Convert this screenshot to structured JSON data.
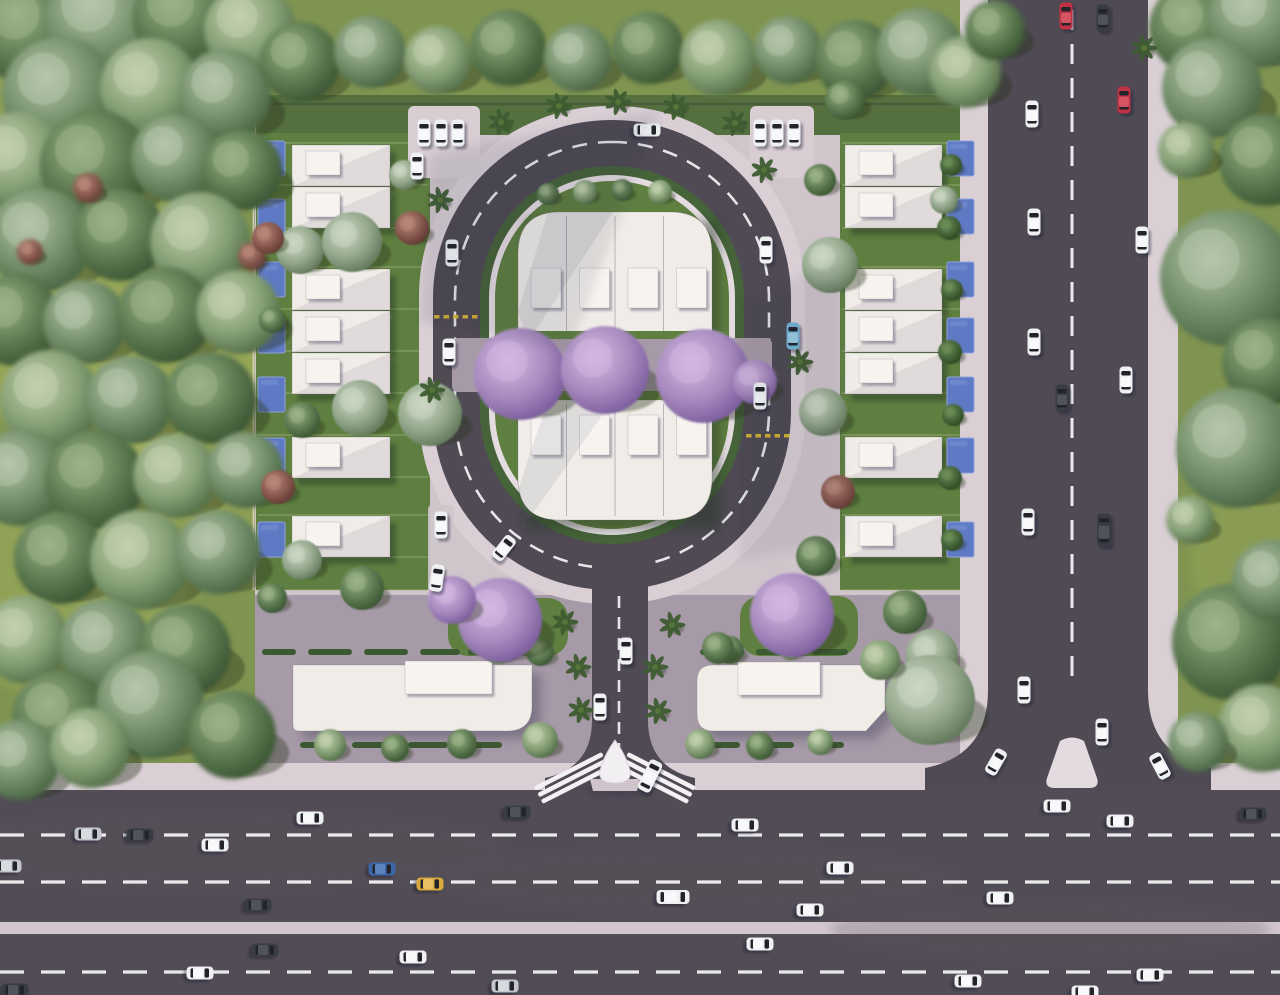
{
  "scene": {
    "w": 1280,
    "h": 995,
    "label": "aerial-residential-masterplan-render"
  },
  "palette": {
    "grass": "#7f9450",
    "lawn": "#5f7f40",
    "topLawn": "#55703f",
    "asphalt": "#514c55",
    "asphaltAvenue": "#4f4a54",
    "sidewalk": "#d9cfd5",
    "median": "#d3c7cd",
    "kerb": "#e4dce1",
    "plaza": "#a79aa8",
    "compoundPave": "#cfc5cb",
    "hedge": "#46633a",
    "white": "#f0ede8",
    "roofBox": "#f7f4f0",
    "island": "#e3dbe0",
    "marking": "#f3f3f6",
    "yellow": "#d9b833",
    "planter": "#3c5a31",
    "bench": "#8a6b4e",
    "glow": "#d8da6e",
    "fence": "#e8e0d4",
    "wall": "#3f4438",
    "dividerLine": "#aab887",
    "treeShadow": "rgba(38,45,28,0.38)",
    "buildShadow": "rgba(40,52,30,0.45)",
    "paveShadow": "rgba(60,60,82,0.38)",
    "cloudShadow": "#232840",
    "pool": "#5f7ac4",
    "poolLight": "#7e97d6",
    "poolDark": "#44straight"
  },
  "treeColors": {
    "f1": {
      "hi": "#b6c7ac",
      "base": "#74906b",
      "lo": "#44603f"
    },
    "f2": {
      "hi": "#9db489",
      "base": "#5e7b52",
      "lo": "#36512f"
    },
    "f3": {
      "hi": "#c3d2ae",
      "base": "#87a178",
      "lo": "#4e6a43"
    },
    "sage": {
      "hi": "#cdd8c4",
      "base": "#95a98e",
      "lo": "#5d7355"
    },
    "red": {
      "hi": "#b98a7c",
      "base": "#8a5a50",
      "lo": "#5e372f"
    },
    "jac": {
      "hi": "#d3b9e2",
      "base": "#a98cc0",
      "lo": "#77589a"
    },
    "bush": {
      "hi": "#6f8f58",
      "base": "#47663a",
      "lo": "#2c441f"
    },
    "palm": {
      "hi": "#55743a",
      "base": "#3e5c31",
      "lo": "#27401f"
    }
  },
  "carColors": {
    "white": {
      "body": "#eef0f2",
      "roof": "#f8f9fb"
    },
    "silver": {
      "body": "#c3c6cc",
      "roof": "#d8dbe0"
    },
    "dark": {
      "body": "#3a3c44",
      "roof": "#50525c"
    },
    "red": {
      "body": "#c03243",
      "roof": "#d45562"
    },
    "blue": {
      "body": "#3c66a8",
      "roof": "#5b83c0"
    },
    "yellow": {
      "body": "#d8a93c",
      "roof": "#e7c064"
    },
    "cyan": {
      "body": "#74b4d6",
      "roof": "#9bcde6"
    }
  },
  "highway": {
    "sidewalk": [
      0,
      763,
      1280,
      27
    ],
    "roadA": [
      0,
      790,
      1280,
      132
    ],
    "dashesA": [
      835,
      882
    ],
    "median": [
      0,
      922,
      1280,
      12
    ],
    "roadB": [
      0,
      934,
      1280,
      61
    ],
    "dashesB": [
      972
    ],
    "dash": "24 17"
  },
  "avenue": {
    "road": [
      988,
      0,
      160,
      790
    ],
    "dashX": 1072,
    "dashY": [
      10,
      688
    ],
    "dash": "20 14",
    "swLeft": [
      960,
      0,
      28,
      765
    ],
    "swRight": [
      1148,
      0,
      30,
      765
    ],
    "flares": [
      "M988,690 Q988,756 925,768 L925,790 L988,790 Z",
      "M1148,690 Q1148,756 1211,768 L1211,790 L1148,790 Z"
    ],
    "island": "M1060,741 Q1072,734 1084,741 L1097,778 Q1100,788 1089,788 L1055,788 Q1044,788 1047,778 Z"
  },
  "compound": {
    "pave": [
      255,
      95,
      710,
      670
    ],
    "topLawn": [
      256,
      95,
      710,
      40
    ],
    "plaza": [
      255,
      595,
      710,
      168
    ],
    "lawnLeft": [
      256,
      133,
      174,
      457
    ],
    "lawnRight": [
      840,
      133,
      136,
      457
    ],
    "lawnPatches": [
      [
        448,
        598,
        120,
        58
      ],
      [
        740,
        596,
        118,
        60
      ]
    ],
    "fenceLeftX": 253.5,
    "fenceRightX": 977,
    "fenceY": [
      133,
      590
    ],
    "wallY": 104,
    "wallX": [
      258,
      960
    ],
    "dividers": [
      143,
      185,
      228,
      267,
      309,
      351,
      393,
      435,
      477,
      515,
      557,
      590
    ],
    "divLeft": [
      258,
      428
    ],
    "divRight": [
      842,
      974
    ],
    "planterY": [
      649,
      742
    ],
    "plantersRow1": [
      [
        262,
        34
      ],
      [
        308,
        44
      ],
      [
        364,
        44
      ],
      [
        420,
        40
      ],
      [
        468,
        44
      ],
      [
        700,
        44
      ],
      [
        756,
        40
      ],
      [
        812,
        36
      ]
    ],
    "plantersRow2": [
      [
        300,
        40
      ],
      [
        352,
        44
      ],
      [
        408,
        40
      ],
      [
        462,
        40
      ],
      [
        700,
        40
      ],
      [
        754,
        40
      ],
      [
        808,
        36
      ]
    ]
  },
  "oval": {
    "sidewalk": [
      419,
      106,
      386,
      498,
      190
    ],
    "road": [
      433,
      120,
      358,
      470,
      178
    ],
    "hedge": [
      480,
      166,
      264,
      378,
      132
    ],
    "kerb": [
      489,
      175,
      246,
      360,
      123
    ],
    "lawn": [
      495,
      181,
      234,
      348,
      117
    ],
    "dashRing": [
      455,
      142,
      314,
      426,
      157
    ],
    "dash": "15 11",
    "yellowRows": [
      [
        434,
        315
      ],
      [
        746,
        434
      ]
    ],
    "parkLeft": [
      408,
      106,
      72,
      72
    ],
    "parkRight": [
      750,
      106,
      64,
      72
    ],
    "parkSide": [
      428,
      505,
      26,
      96
    ]
  },
  "entrance": {
    "road": [
      592,
      560,
      56,
      230
    ],
    "dashX": 619,
    "dashY": [
      596,
      757
    ],
    "dash": "12 9",
    "flares": [
      "M592,720 Q592,768 545,778 L545,790 L592,790 Z",
      "M648,720 Q648,768 695,778 L695,790 L648,790 Z"
    ]
  },
  "innerBlock": {
    "top": {
      "path": "M518,342 L518,254 Q518,212 560,212 L670,212 Q712,212 712,254 L712,342 Z",
      "boxY": 268
    },
    "bottom": {
      "path": "M518,400 L712,400 L712,478 Q712,520 670,520 L560,520 Q518,520 518,478 Z",
      "boxY": 415
    },
    "x": 518,
    "w": 194,
    "unitW": 48.5,
    "units": 4,
    "box": {
      "dx": 13,
      "w": 30,
      "h": 40
    },
    "dividerX": [
      566.5,
      615,
      663.5
    ],
    "topYr": [
      212,
      342
    ],
    "botYr": [
      400,
      520
    ],
    "walkway": [
      452,
      338,
      320,
      54
    ],
    "benches": [
      [
        537,
        348
      ],
      [
        695,
        350
      ]
    ],
    "lawnStrips": [
      [
        495,
        331,
        234,
        8
      ],
      [
        495,
        391,
        234,
        9
      ]
    ]
  },
  "houses": {
    "rowYs": [
      145,
      187,
      269,
      311,
      353,
      437,
      516
    ],
    "h": 41,
    "leftX": 292,
    "leftW": 98,
    "rightX": 845,
    "rightW": 97,
    "box": {
      "dx": 14,
      "dy": 6,
      "w": 34,
      "h": 24
    }
  },
  "pools": {
    "ys": [
      141,
      199,
      262,
      318,
      377,
      438,
      522
    ],
    "leftX": 258,
    "rightX": 947,
    "w": 27,
    "h": 35
  },
  "bottomBuildings": {
    "left": {
      "path": "M293,665 L532,665 L532,706 Q532,731 507,731 L299,731 Q293,731 293,725 Z",
      "box": [
        405,
        661,
        87,
        33
      ]
    },
    "right": {
      "path": "M713,665 L885,665 L885,710 L866,731 L713,731 Q697,731 697,714 L697,681 Q697,665 713,665 Z",
      "box": [
        738,
        662,
        82,
        33
      ]
    }
  },
  "gate": {
    "cx": 615,
    "base": "M590,779 L640,779 L637,791 L593,791 Z",
    "shield": "M615,740 Q603,757 600,771 Q598,783 615,783 Q632,783 630,771 Q627,757 615,740 Z",
    "wingLen": 76,
    "wingAngle": 27
  },
  "forestTrees": [
    [
      30,
      30,
      55,
      "f2"
    ],
    [
      105,
      22,
      60,
      "f1"
    ],
    [
      185,
      18,
      52,
      "f2"
    ],
    [
      250,
      30,
      46,
      "f3"
    ],
    [
      60,
      95,
      58,
      "f1"
    ],
    [
      150,
      88,
      50,
      "f3"
    ],
    [
      225,
      95,
      46,
      "f1"
    ],
    [
      18,
      162,
      50,
      "f3"
    ],
    [
      95,
      165,
      55,
      "f2"
    ],
    [
      175,
      158,
      44,
      "f1"
    ],
    [
      242,
      170,
      40,
      "f2"
    ],
    [
      40,
      240,
      52,
      "f1"
    ],
    [
      120,
      235,
      46,
      "f2"
    ],
    [
      200,
      242,
      50,
      "f3"
    ],
    [
      15,
      320,
      46,
      "f2"
    ],
    [
      85,
      322,
      42,
      "f1"
    ],
    [
      165,
      315,
      48,
      "f2"
    ],
    [
      238,
      312,
      42,
      "f3"
    ],
    [
      50,
      400,
      50,
      "f3"
    ],
    [
      130,
      400,
      44,
      "f1"
    ],
    [
      210,
      398,
      46,
      "f2"
    ],
    [
      20,
      478,
      48,
      "f1"
    ],
    [
      95,
      480,
      50,
      "f2"
    ],
    [
      175,
      476,
      42,
      "f3"
    ],
    [
      245,
      470,
      38,
      "f1"
    ],
    [
      60,
      558,
      46,
      "f2"
    ],
    [
      140,
      560,
      50,
      "f3"
    ],
    [
      218,
      552,
      42,
      "f1"
    ],
    [
      25,
      640,
      44,
      "f3"
    ],
    [
      105,
      645,
      46,
      "f1"
    ],
    [
      185,
      650,
      46,
      "f2"
    ],
    [
      60,
      718,
      48,
      "f2"
    ],
    [
      150,
      705,
      54,
      "f1"
    ],
    [
      232,
      735,
      44,
      "f2"
    ],
    [
      20,
      760,
      40,
      "f1"
    ],
    [
      90,
      748,
      40,
      "f3"
    ],
    [
      88,
      188,
      15,
      "red"
    ],
    [
      252,
      256,
      14,
      "red"
    ],
    [
      30,
      252,
      13,
      "red"
    ],
    [
      300,
      62,
      40,
      "f2"
    ],
    [
      370,
      52,
      36,
      "f1"
    ],
    [
      438,
      60,
      34,
      "f3"
    ],
    [
      508,
      48,
      38,
      "f2"
    ],
    [
      578,
      58,
      34,
      "f1"
    ],
    [
      648,
      48,
      36,
      "f2"
    ],
    [
      718,
      58,
      38,
      "f3"
    ],
    [
      788,
      50,
      34,
      "f1"
    ],
    [
      855,
      60,
      40,
      "f2"
    ],
    [
      920,
      52,
      44,
      "f1"
    ],
    [
      965,
      72,
      36,
      "f3"
    ],
    [
      995,
      30,
      30,
      "f2"
    ],
    [
      1195,
      28,
      46,
      "f2"
    ],
    [
      1258,
      18,
      50,
      "f1"
    ],
    [
      1212,
      88,
      50,
      "f1"
    ],
    [
      1265,
      160,
      46,
      "f2"
    ],
    [
      1186,
      150,
      28,
      "f3"
    ],
    [
      1228,
      278,
      68,
      "f1"
    ],
    [
      1266,
      362,
      44,
      "f2"
    ],
    [
      1236,
      448,
      60,
      "f1"
    ],
    [
      1190,
      520,
      24,
      "f3"
    ],
    [
      1230,
      642,
      58,
      "f2"
    ],
    [
      1272,
      580,
      40,
      "f1"
    ],
    [
      1262,
      728,
      44,
      "f3"
    ],
    [
      1198,
      742,
      30,
      "f1"
    ]
  ],
  "gardenTrees": [
    [
      300,
      250,
      24,
      "sage"
    ],
    [
      352,
      242,
      30,
      "sage"
    ],
    [
      268,
      238,
      16,
      "red"
    ],
    [
      272,
      320,
      13,
      "f2"
    ],
    [
      360,
      408,
      28,
      "sage"
    ],
    [
      302,
      420,
      18,
      "f2"
    ],
    [
      430,
      414,
      32,
      "sage"
    ],
    [
      278,
      487,
      17,
      "red"
    ],
    [
      302,
      560,
      20,
      "sage"
    ],
    [
      362,
      588,
      22,
      "f2"
    ],
    [
      272,
      598,
      15,
      "f2"
    ],
    [
      412,
      228,
      17,
      "red"
    ],
    [
      404,
      175,
      15,
      "sage"
    ],
    [
      830,
      265,
      28,
      "sage"
    ],
    [
      838,
      492,
      17,
      "red"
    ],
    [
      823,
      412,
      24,
      "sage"
    ],
    [
      816,
      556,
      20,
      "f2"
    ],
    [
      905,
      612,
      22,
      "f2"
    ],
    [
      932,
      655,
      26,
      "sage"
    ],
    [
      845,
      100,
      20,
      "f2"
    ],
    [
      944,
      200,
      14,
      "sage"
    ],
    [
      820,
      180,
      16,
      "f2"
    ],
    [
      951,
      165,
      11,
      "bush"
    ],
    [
      949,
      228,
      12,
      "bush"
    ],
    [
      952,
      290,
      11,
      "bush"
    ],
    [
      950,
      352,
      12,
      "bush"
    ],
    [
      953,
      415,
      11,
      "bush"
    ],
    [
      950,
      478,
      12,
      "bush"
    ],
    [
      952,
      540,
      11,
      "bush"
    ],
    [
      548,
      194,
      11,
      "f2"
    ],
    [
      585,
      192,
      12,
      "f3"
    ],
    [
      622,
      190,
      11,
      "f2"
    ],
    [
      660,
      192,
      12,
      "f3"
    ],
    [
      498,
      648,
      16,
      "f3"
    ],
    [
      540,
      652,
      14,
      "f2"
    ],
    [
      462,
      744,
      15,
      "f2"
    ],
    [
      330,
      745,
      16,
      "f3"
    ],
    [
      395,
      748,
      14,
      "f2"
    ],
    [
      540,
      740,
      18,
      "f3"
    ],
    [
      730,
      650,
      14,
      "f2"
    ],
    [
      790,
      648,
      12,
      "f3"
    ],
    [
      700,
      744,
      15,
      "f3"
    ],
    [
      760,
      746,
      14,
      "f2"
    ],
    [
      820,
      742,
      13,
      "f3"
    ],
    [
      718,
      648,
      16,
      "f2"
    ],
    [
      930,
      700,
      45,
      "sage"
    ],
    [
      880,
      660,
      20,
      "f3"
    ]
  ],
  "jacarandas": [
    [
      520,
      374,
      46
    ],
    [
      605,
      370,
      44
    ],
    [
      703,
      376,
      47
    ],
    [
      755,
      382,
      22
    ],
    [
      500,
      620,
      42
    ],
    [
      452,
      600,
      24
    ],
    [
      792,
      615,
      42
    ]
  ],
  "palms": [
    [
      440,
      200
    ],
    [
      501,
      122
    ],
    [
      559,
      106
    ],
    [
      618,
      102
    ],
    [
      676,
      107
    ],
    [
      735,
      123
    ],
    [
      764,
      170
    ],
    [
      432,
      390
    ],
    [
      800,
      362
    ],
    [
      565,
      622
    ],
    [
      672,
      625
    ],
    [
      578,
      667
    ],
    [
      581,
      710
    ],
    [
      655,
      667
    ],
    [
      658,
      711
    ],
    [
      1144,
      48
    ]
  ],
  "cars": [
    [
      647,
      130,
      90,
      "white",
      "c"
    ],
    [
      452,
      253,
      0,
      "white",
      "c"
    ],
    [
      449,
      352,
      0,
      "white",
      "c"
    ],
    [
      504,
      548,
      38,
      "white",
      "c"
    ],
    [
      441,
      525,
      0,
      "white",
      "c"
    ],
    [
      437,
      578,
      8,
      "white",
      "c"
    ],
    [
      766,
      250,
      0,
      "white",
      "c"
    ],
    [
      793,
      336,
      0,
      "cyan",
      "c"
    ],
    [
      760,
      396,
      0,
      "white",
      "c"
    ],
    [
      626,
      651,
      0,
      "white",
      "c"
    ],
    [
      600,
      707,
      0,
      "white",
      "c"
    ],
    [
      650,
      776,
      26,
      "white",
      "v"
    ],
    [
      424,
      133,
      0,
      "white",
      "c"
    ],
    [
      441,
      133,
      0,
      "white",
      "c"
    ],
    [
      458,
      133,
      0,
      "white",
      "c"
    ],
    [
      417,
      166,
      0,
      "white",
      "c"
    ],
    [
      760,
      133,
      0,
      "white",
      "c"
    ],
    [
      777,
      133,
      0,
      "white",
      "c"
    ],
    [
      794,
      133,
      0,
      "white",
      "c"
    ],
    [
      1066,
      16,
      0,
      "red",
      "c"
    ],
    [
      1103,
      18,
      0,
      "dark",
      "c"
    ],
    [
      1032,
      114,
      0,
      "white",
      "c"
    ],
    [
      1124,
      100,
      0,
      "red",
      "c"
    ],
    [
      1034,
      222,
      0,
      "white",
      "c"
    ],
    [
      1142,
      240,
      0,
      "white",
      "c"
    ],
    [
      1034,
      342,
      0,
      "white",
      "c"
    ],
    [
      1062,
      398,
      0,
      "dark",
      "c"
    ],
    [
      1126,
      380,
      0,
      "white",
      "c"
    ],
    [
      1028,
      522,
      0,
      "white",
      "c"
    ],
    [
      1104,
      530,
      0,
      "dark",
      "v"
    ],
    [
      1024,
      690,
      0,
      "white",
      "c"
    ],
    [
      1102,
      732,
      0,
      "white",
      "c"
    ],
    [
      996,
      762,
      30,
      "white",
      "c"
    ],
    [
      1160,
      766,
      -28,
      "white",
      "c"
    ],
    [
      8,
      866,
      90,
      "silver",
      "c"
    ],
    [
      88,
      834,
      90,
      "silver",
      "c"
    ],
    [
      140,
      835,
      90,
      "dark",
      "c"
    ],
    [
      215,
      845,
      90,
      "white",
      "c"
    ],
    [
      310,
      818,
      90,
      "white",
      "c"
    ],
    [
      517,
      812,
      90,
      "dark",
      "c"
    ],
    [
      382,
      869,
      90,
      "blue",
      "c"
    ],
    [
      430,
      884,
      90,
      "yellow",
      "c"
    ],
    [
      258,
      905,
      90,
      "dark",
      "c"
    ],
    [
      745,
      825,
      90,
      "white",
      "c"
    ],
    [
      673,
      897,
      90,
      "white",
      "v"
    ],
    [
      840,
      868,
      90,
      "white",
      "c"
    ],
    [
      810,
      910,
      90,
      "white",
      "c"
    ],
    [
      1000,
      898,
      90,
      "white",
      "c"
    ],
    [
      1057,
      806,
      90,
      "white",
      "c"
    ],
    [
      1120,
      821,
      90,
      "white",
      "c"
    ],
    [
      1253,
      814,
      90,
      "dark",
      "c"
    ],
    [
      265,
      950,
      90,
      "dark",
      "c"
    ],
    [
      413,
      957,
      90,
      "white",
      "c"
    ],
    [
      200,
      973,
      90,
      "white",
      "c"
    ],
    [
      505,
      986,
      90,
      "silver",
      "c"
    ],
    [
      760,
      944,
      90,
      "white",
      "c"
    ],
    [
      968,
      981,
      90,
      "white",
      "c"
    ],
    [
      1150,
      975,
      90,
      "white",
      "c"
    ],
    [
      1085,
      992,
      90,
      "white",
      "c"
    ],
    [
      15,
      990,
      90,
      "dark",
      "c"
    ]
  ],
  "effects": {
    "glows": [
      [
        120,
        330,
        160,
        130,
        0.26
      ],
      [
        70,
        600,
        120,
        100,
        0.2
      ],
      [
        40,
        140,
        100,
        80,
        0.18
      ],
      [
        180,
        470,
        110,
        90,
        0.16
      ],
      [
        1250,
        560,
        60,
        80,
        0.12
      ]
    ],
    "cloudShadows": [
      {
        "path": "M430,155 L660,110 L570,350 L420,320 Z",
        "op": 0.1
      },
      {
        "path": "M740,300 L840,260 L845,540 L740,560 Z",
        "op": 0.07
      }
    ]
  }
}
